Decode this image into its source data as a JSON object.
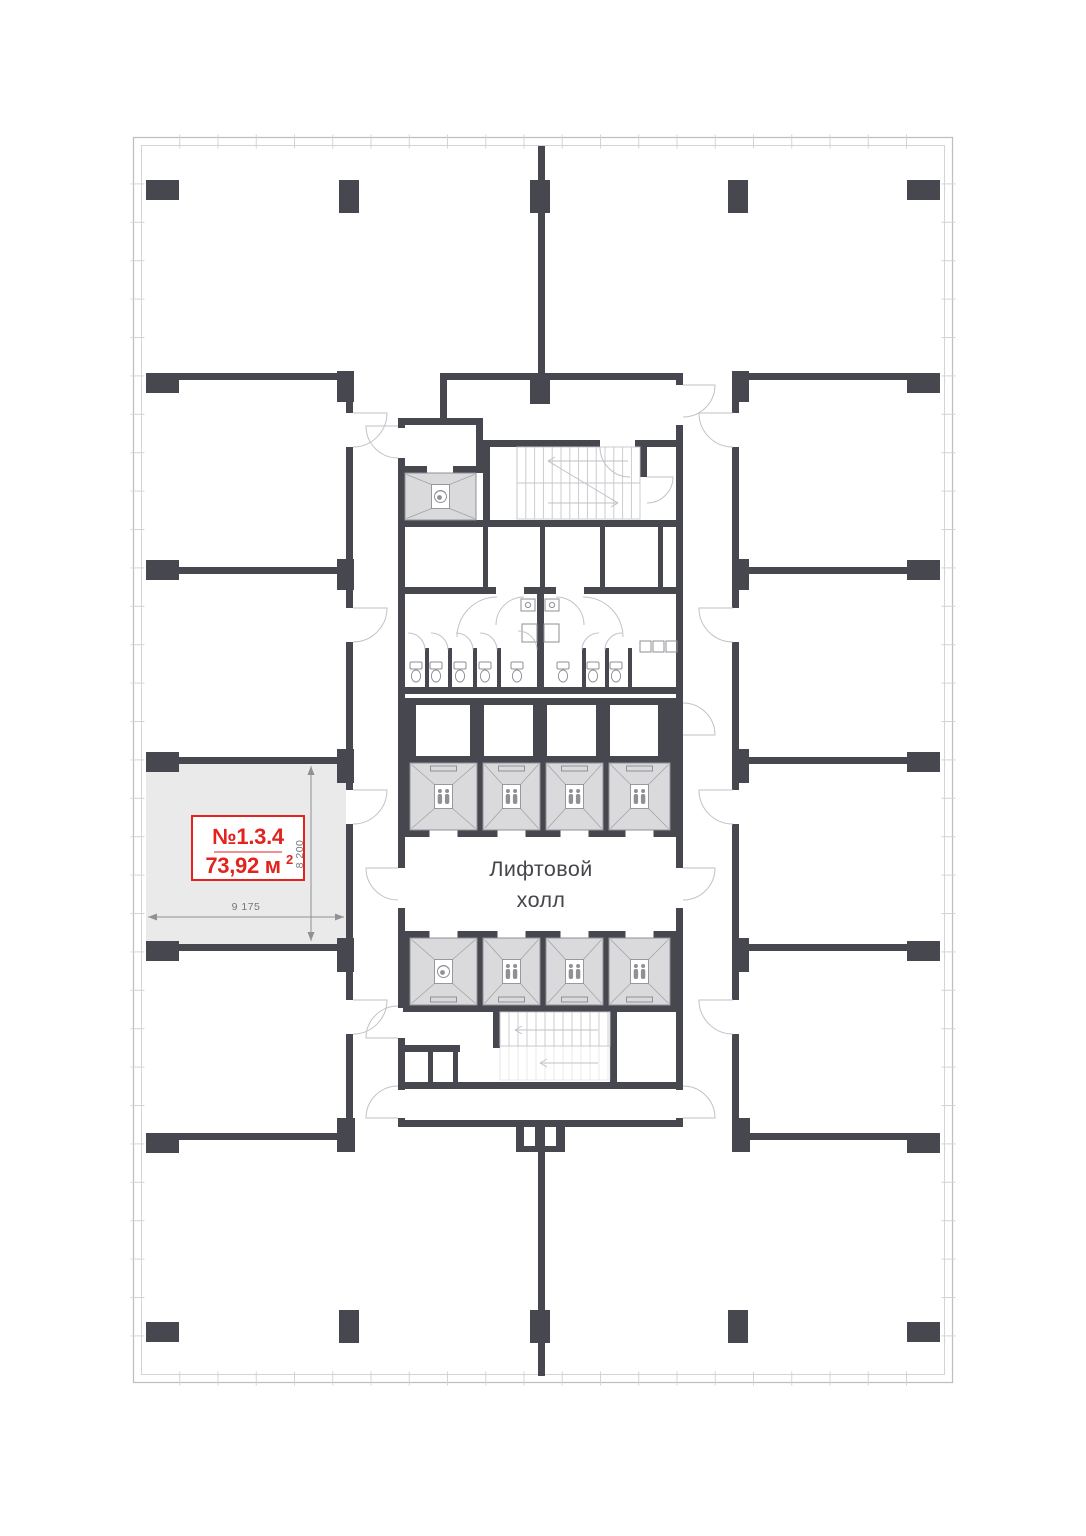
{
  "plan": {
    "unit": {
      "number": "№1.3.4",
      "area": "73,92 м²",
      "area_main": "73,92 м",
      "area_sup": "2"
    },
    "dimensions": {
      "width": "9 175",
      "height": "8 200"
    },
    "elevator_hall": {
      "line1": "Лифтовой",
      "line2": "холл"
    }
  },
  "colors": {
    "wall": "#47474F",
    "accent_red": "#E2231E",
    "room_fill": "#EAEAEA",
    "lift_fill": "#DADADD",
    "lift_line": "#8F8F96",
    "light_line": "#C7C7CC",
    "arc_line": "#C2C2C7",
    "dim_line": "#909095",
    "dim_text": "#77777C",
    "text_dark": "#45454C",
    "frame_line": "#BDBDC2",
    "frame_inner": "#D4D4D8"
  }
}
